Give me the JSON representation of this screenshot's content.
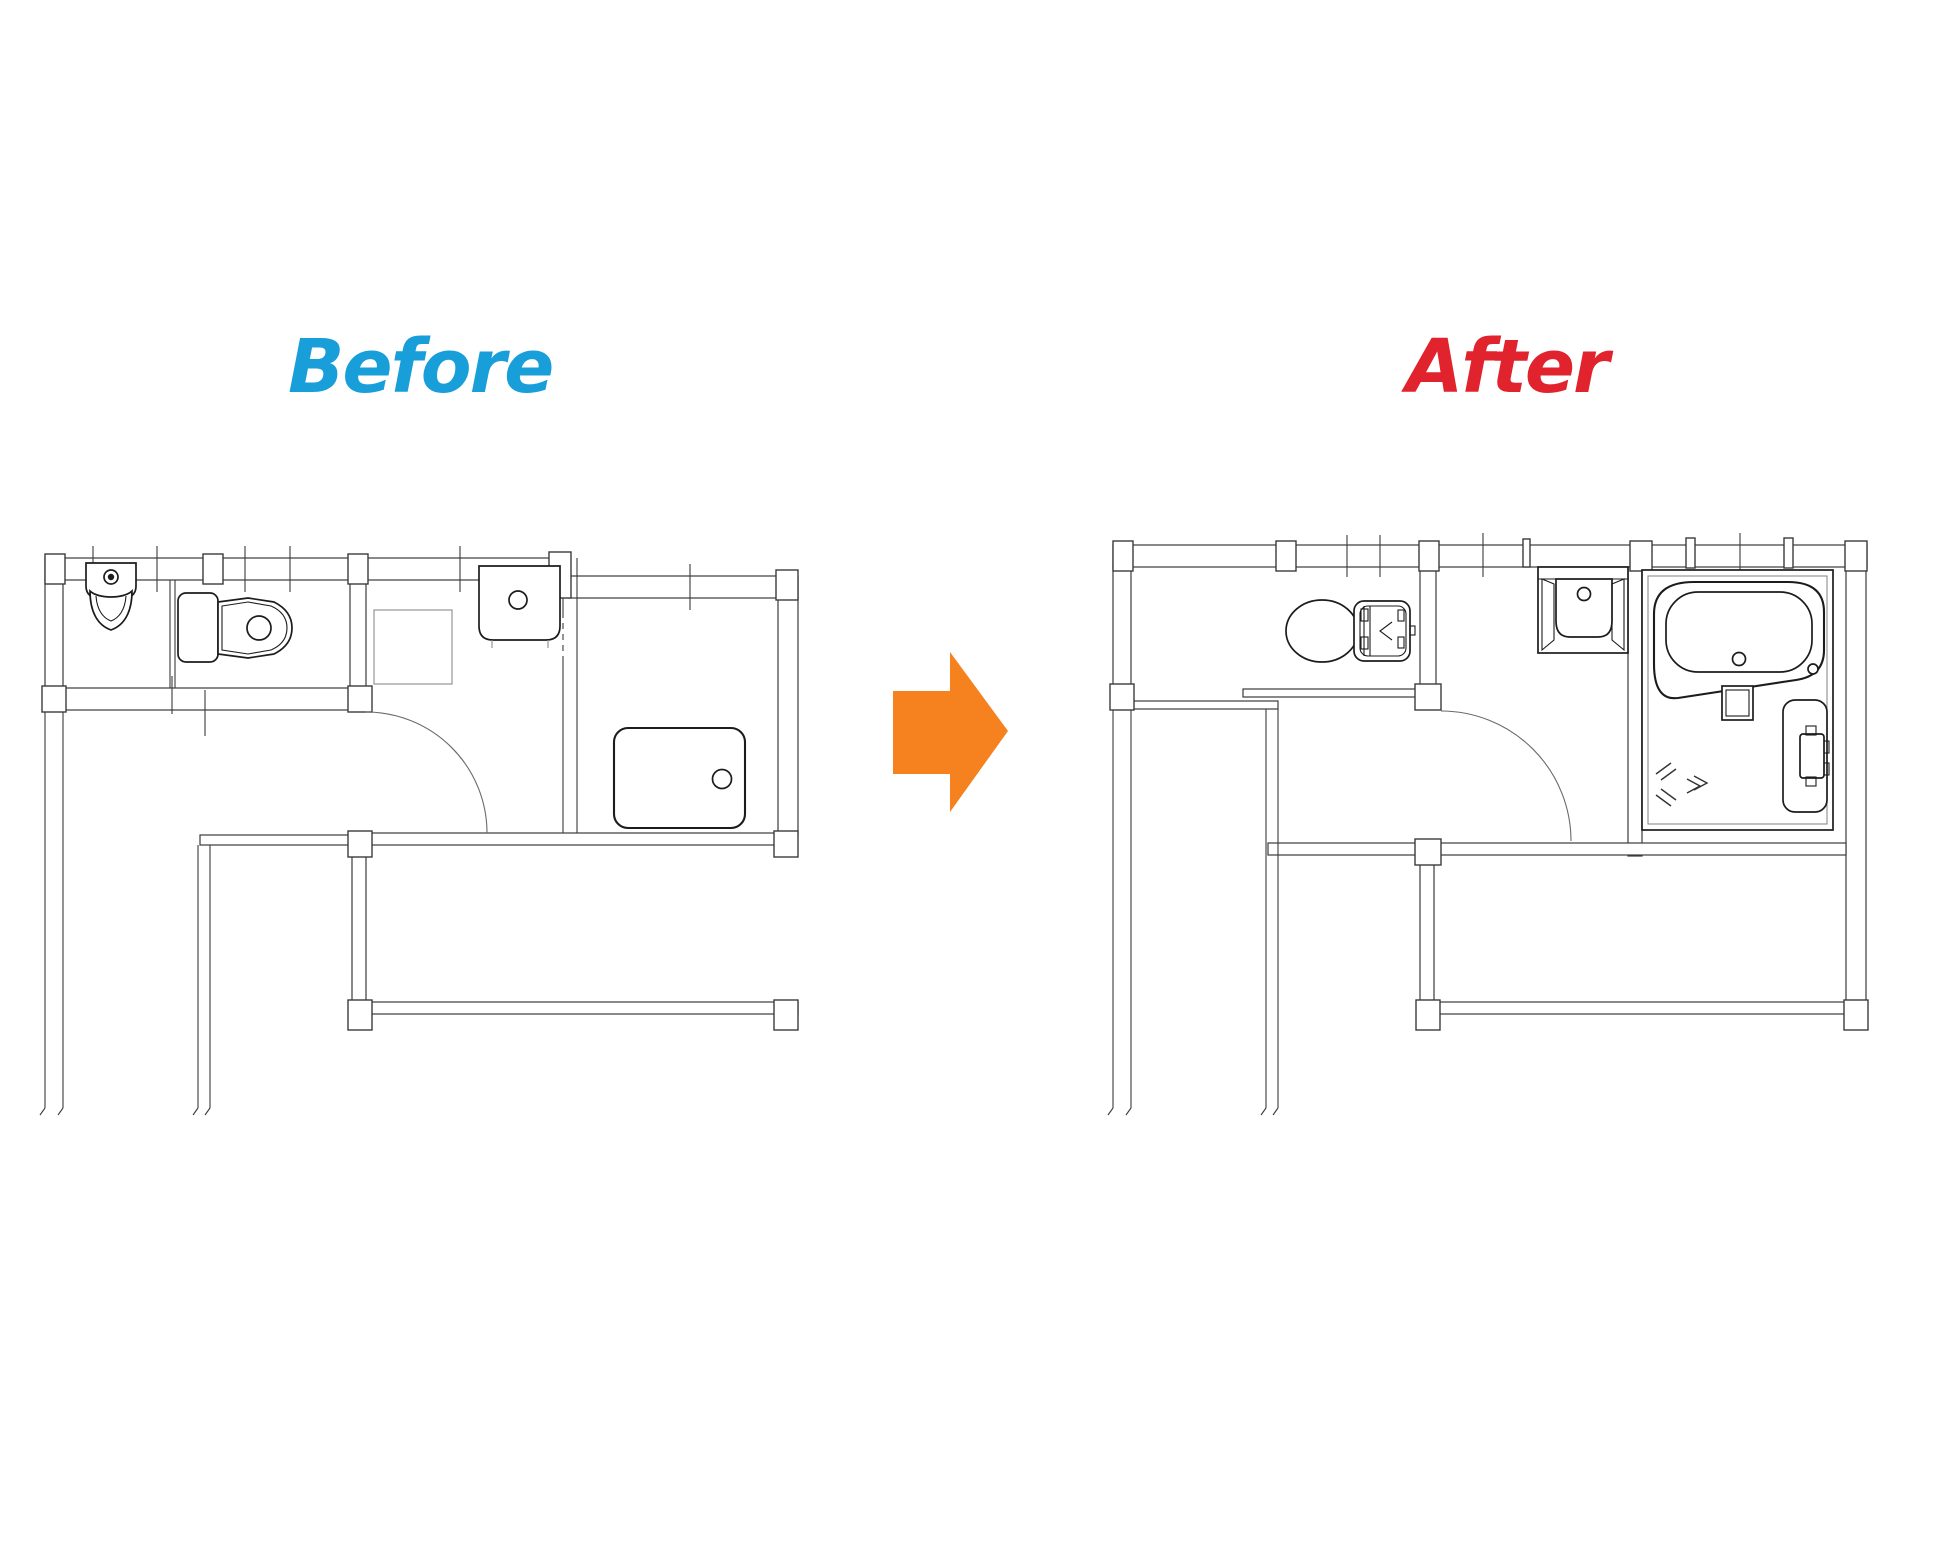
{
  "canvas": {
    "width": 1939,
    "height": 1552,
    "background": "#FFFFFF",
    "line_color": "#3B3B3B"
  },
  "titles": {
    "before": {
      "label": "Before",
      "color": "#189ED9"
    },
    "after": {
      "label": "After",
      "color": "#E0232C"
    }
  },
  "arrow": {
    "name": "right-arrow-icon",
    "direction": "right",
    "color": "#F5821F"
  },
  "plans": {
    "before": {
      "name": "before-floor-plan",
      "rooms": [
        "urinal-room",
        "toilet-room",
        "washroom",
        "bathroom",
        "hallway"
      ],
      "fixtures": [
        "urinal",
        "toilet-with-tank",
        "washing-machine-pan",
        "washbasin",
        "bathtub",
        "hinged-door",
        "sliding-partition"
      ]
    },
    "after": {
      "name": "after-floor-plan",
      "rooms": [
        "toilet-room",
        "washroom",
        "unit-bathroom",
        "hallway"
      ],
      "fixtures": [
        "tankless-toilet",
        "sliding-door",
        "hinged-door",
        "vanity-basin",
        "unit-bath",
        "oval-bathtub",
        "shower-counter",
        "shower-mixer",
        "shower-spray-marks",
        "window"
      ]
    }
  }
}
